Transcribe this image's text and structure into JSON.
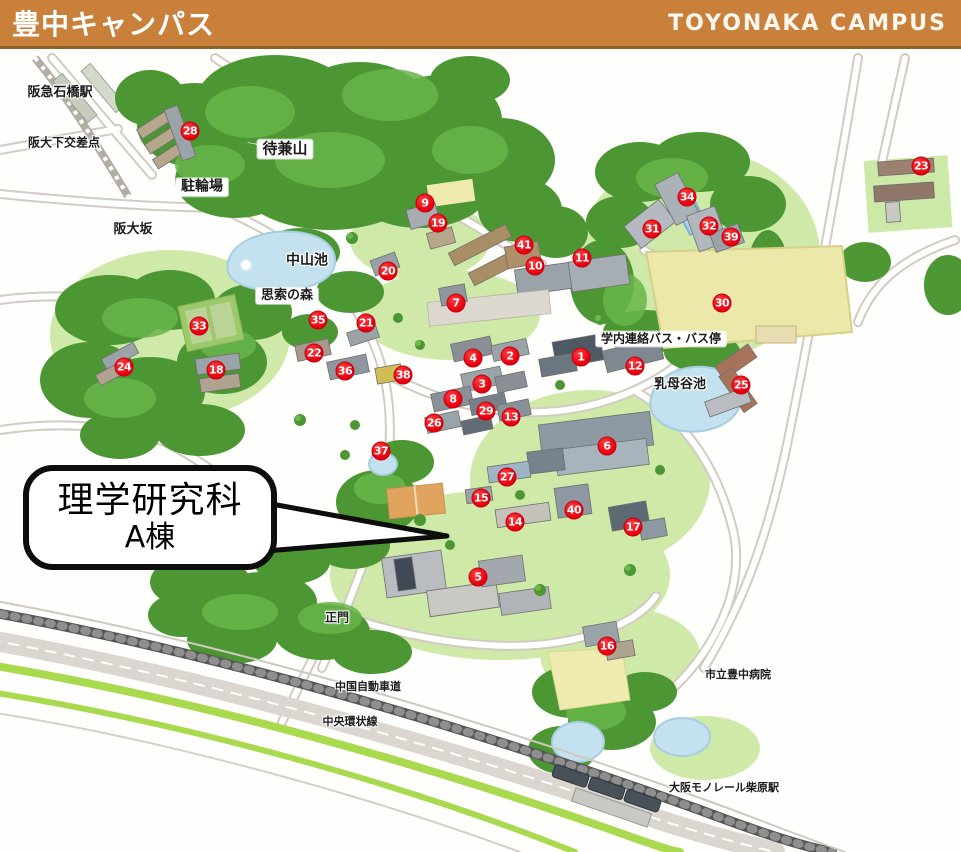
{
  "header": {
    "title_ja": "豊中キャンパス",
    "title_en": "TOYONAKA CAMPUS"
  },
  "callout": {
    "line1": "理学研究科",
    "line2": "A棟"
  },
  "colors": {
    "header_bg": "#c9803b",
    "header_border": "#8d6227",
    "marker_red": "#e8000f",
    "marker_border": "#c40011",
    "forest_green": "#55a23c",
    "pond_blue": "#c3e1ee",
    "field_yellow": "#ebe8a9"
  },
  "markers": [
    {
      "n": 1,
      "x": 581,
      "y": 357
    },
    {
      "n": 2,
      "x": 510,
      "y": 356
    },
    {
      "n": 3,
      "x": 482,
      "y": 384
    },
    {
      "n": 4,
      "x": 473,
      "y": 358
    },
    {
      "n": 5,
      "x": 478,
      "y": 577
    },
    {
      "n": 6,
      "x": 607,
      "y": 446
    },
    {
      "n": 7,
      "x": 456,
      "y": 303
    },
    {
      "n": 8,
      "x": 453,
      "y": 399
    },
    {
      "n": 9,
      "x": 425,
      "y": 203
    },
    {
      "n": 10,
      "x": 535,
      "y": 266
    },
    {
      "n": 11,
      "x": 582,
      "y": 258
    },
    {
      "n": 12,
      "x": 635,
      "y": 366
    },
    {
      "n": 13,
      "x": 511,
      "y": 417
    },
    {
      "n": 14,
      "x": 515,
      "y": 522
    },
    {
      "n": 15,
      "x": 481,
      "y": 498
    },
    {
      "n": 16,
      "x": 607,
      "y": 646
    },
    {
      "n": 17,
      "x": 633,
      "y": 527
    },
    {
      "n": 18,
      "x": 216,
      "y": 370
    },
    {
      "n": 19,
      "x": 438,
      "y": 223
    },
    {
      "n": 20,
      "x": 388,
      "y": 271
    },
    {
      "n": 21,
      "x": 366,
      "y": 323
    },
    {
      "n": 22,
      "x": 314,
      "y": 353
    },
    {
      "n": 23,
      "x": 921,
      "y": 166
    },
    {
      "n": 24,
      "x": 124,
      "y": 367
    },
    {
      "n": 25,
      "x": 741,
      "y": 385
    },
    {
      "n": 26,
      "x": 434,
      "y": 423
    },
    {
      "n": 27,
      "x": 507,
      "y": 477
    },
    {
      "n": 28,
      "x": 190,
      "y": 131
    },
    {
      "n": 29,
      "x": 486,
      "y": 411
    },
    {
      "n": 30,
      "x": 722,
      "y": 303
    },
    {
      "n": 31,
      "x": 652,
      "y": 229
    },
    {
      "n": 32,
      "x": 709,
      "y": 226
    },
    {
      "n": 33,
      "x": 199,
      "y": 326
    },
    {
      "n": 34,
      "x": 687,
      "y": 197
    },
    {
      "n": 35,
      "x": 318,
      "y": 320
    },
    {
      "n": 36,
      "x": 345,
      "y": 371
    },
    {
      "n": 37,
      "x": 381,
      "y": 451
    },
    {
      "n": 38,
      "x": 403,
      "y": 375
    },
    {
      "n": 39,
      "x": 731,
      "y": 237
    },
    {
      "n": 40,
      "x": 574,
      "y": 510
    },
    {
      "n": 41,
      "x": 524,
      "y": 245
    }
  ],
  "labels": [
    {
      "id": "hankyu-ishibashi-station",
      "text": "阪急石橋駅",
      "x": 60,
      "y": 93,
      "boxed": false,
      "fs": 13
    },
    {
      "id": "handai-shita-crossing",
      "text": "阪大下交差点",
      "x": 64,
      "y": 143,
      "boxed": false,
      "fs": 12
    },
    {
      "id": "machikaneyama",
      "text": "待兼山",
      "x": 285,
      "y": 149,
      "boxed": true,
      "fs": 15
    },
    {
      "id": "bicycle-parking",
      "text": "駐輪場",
      "x": 202,
      "y": 187,
      "boxed": true,
      "fs": 14
    },
    {
      "id": "handai-zaka",
      "text": "阪大坂",
      "x": 133,
      "y": 230,
      "boxed": false,
      "fs": 13
    },
    {
      "id": "nakayama-pond",
      "text": "中山池",
      "x": 307,
      "y": 261,
      "boxed": false,
      "fs": 14
    },
    {
      "id": "shisaku-no-mori",
      "text": "思索の森",
      "x": 287,
      "y": 296,
      "boxed": true,
      "fs": 13
    },
    {
      "id": "campus-shuttle-bus-stop",
      "text": "学内連絡バス・バス停",
      "x": 661,
      "y": 339,
      "boxed": true,
      "fs": 12
    },
    {
      "id": "ubagai-pond",
      "text": "乳母谷池",
      "x": 680,
      "y": 385,
      "boxed": false,
      "fs": 13
    },
    {
      "id": "main-gate",
      "text": "正門",
      "x": 337,
      "y": 618,
      "boxed": false,
      "fs": 12
    },
    {
      "id": "chugoku-expressway",
      "text": "中国自動車道",
      "x": 368,
      "y": 687,
      "boxed": false,
      "fs": 11
    },
    {
      "id": "chuo-kanjo-route",
      "text": "中央環状線",
      "x": 350,
      "y": 722,
      "boxed": false,
      "fs": 11
    },
    {
      "id": "toyonaka-city-hospital",
      "text": "市立豊中病院",
      "x": 738,
      "y": 675,
      "boxed": false,
      "fs": 11
    },
    {
      "id": "osaka-monorail-shibahara",
      "text": "大阪モノレール柴原駅",
      "x": 724,
      "y": 788,
      "boxed": false,
      "fs": 11
    }
  ]
}
